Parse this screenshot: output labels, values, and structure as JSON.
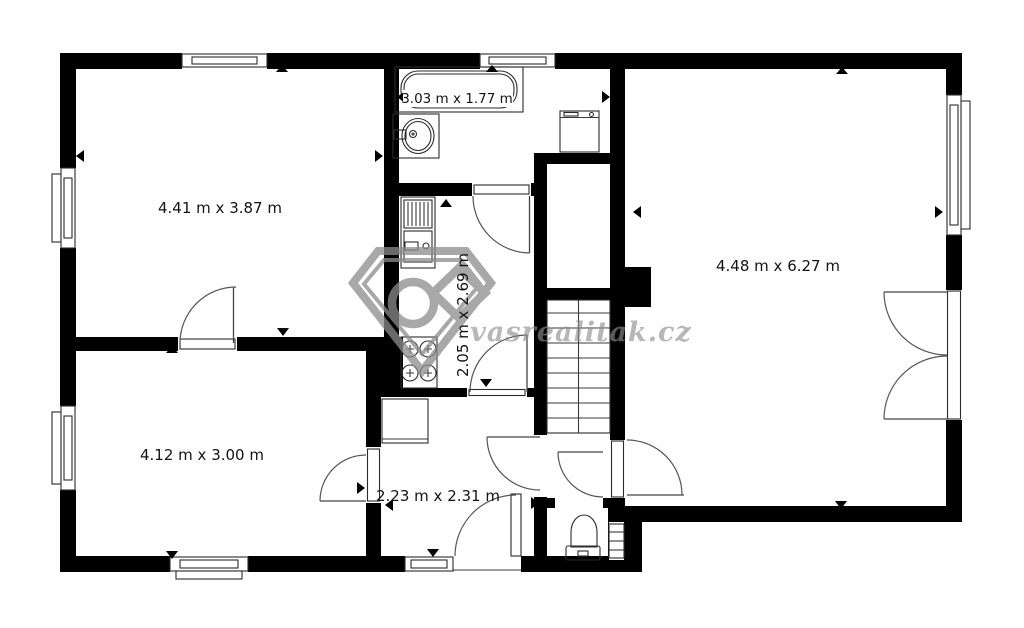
{
  "page": {
    "background_color": "#ffffff",
    "wall_color": "#000000",
    "line_color": "#2b2b2b",
    "watermark_color": "#8f8f8f"
  },
  "watermark": {
    "brand_text": "vasrealitak.cz",
    "logo": "gem-diamond-logo"
  },
  "floorplan": {
    "type": "floor-plan",
    "rooms": [
      {
        "id": "room-top-left",
        "dimensions_label": "4.41 m x 3.87 m"
      },
      {
        "id": "bathroom",
        "dimensions_label": "3.03 m x 1.77 m"
      },
      {
        "id": "kitchen-hall",
        "dimensions_label": "2.05 m x 2.69 m"
      },
      {
        "id": "room-right",
        "dimensions_label": "4.48 m x 6.27 m"
      },
      {
        "id": "room-bottom-left",
        "dimensions_label": "4.12 m x 3.00 m"
      },
      {
        "id": "entrance-hall",
        "dimensions_label": "2.23 m x 2.31 m"
      }
    ],
    "fixtures": [
      {
        "id": "bathtub"
      },
      {
        "id": "wash-basin"
      },
      {
        "id": "washing-machine"
      },
      {
        "id": "kitchen-sink-counter"
      },
      {
        "id": "stove"
      },
      {
        "id": "hall-cabinet"
      },
      {
        "id": "toilet"
      },
      {
        "id": "staircase"
      }
    ]
  }
}
